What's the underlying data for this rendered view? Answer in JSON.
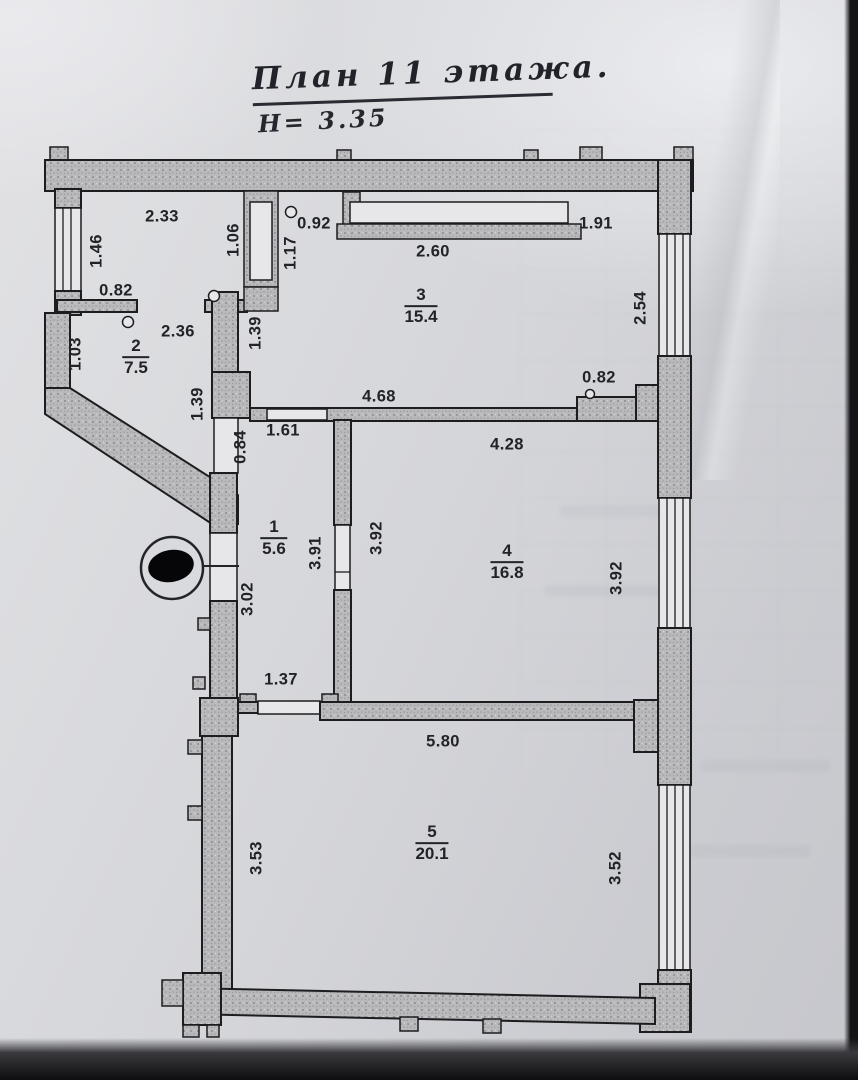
{
  "title": {
    "main": "План 11 этажа.",
    "height_note": "Н= 3.35"
  },
  "rooms": [
    {
      "number": "1",
      "area": "5.6"
    },
    {
      "number": "2",
      "area": "7.5"
    },
    {
      "number": "3",
      "area": "15.4"
    },
    {
      "number": "4",
      "area": "16.8"
    },
    {
      "number": "5",
      "area": "20.1"
    }
  ],
  "dims": [
    {
      "v": "2.33"
    },
    {
      "v": "1.46"
    },
    {
      "v": "0.82"
    },
    {
      "v": "1.06"
    },
    {
      "v": "0.92"
    },
    {
      "v": "1.17"
    },
    {
      "v": "2.60"
    },
    {
      "v": "1.91"
    },
    {
      "v": "2.54"
    },
    {
      "v": "1.03"
    },
    {
      "v": "2.36"
    },
    {
      "v": "1.39"
    },
    {
      "v": "4.68"
    },
    {
      "v": "0.82"
    },
    {
      "v": "1.39"
    },
    {
      "v": "0.84"
    },
    {
      "v": "1.61"
    },
    {
      "v": "4.28"
    },
    {
      "v": "3.91"
    },
    {
      "v": "3.92"
    },
    {
      "v": "3.92"
    },
    {
      "v": "3.02"
    },
    {
      "v": "1.37"
    },
    {
      "v": "5.80"
    },
    {
      "v": "3.53"
    },
    {
      "v": "3.52"
    }
  ]
}
